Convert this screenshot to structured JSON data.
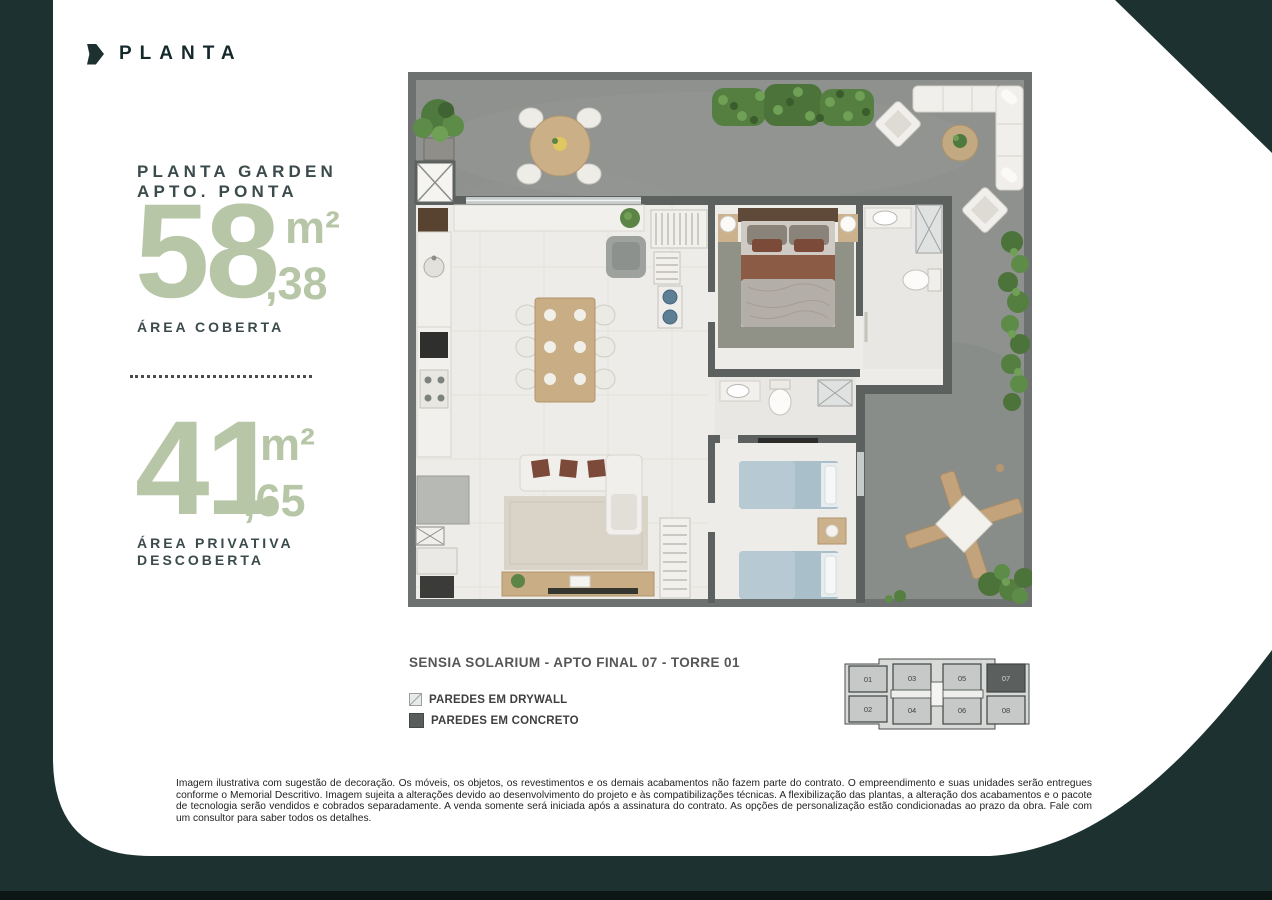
{
  "header": {
    "title": "PLANTA"
  },
  "colors": {
    "dark_green": "#1d3230",
    "sage": "#b8c6a8",
    "heading": "#3b4a4b"
  },
  "info": {
    "heading_line1": "PLANTA GARDEN",
    "heading_line2": "APTO. PONTA",
    "area_coberta": {
      "value": "58",
      "unit": "m²",
      "decimal": ",38",
      "label": "ÁREA COBERTA"
    },
    "area_descoberta": {
      "value": "41",
      "unit": "m²",
      "decimal": ",65",
      "label_line1": "ÁREA PRIVATIVA",
      "label_line2": "DESCOBERTA"
    }
  },
  "plan": {
    "caption": "SENSIA SOLARIUM - APTO FINAL 07 - TORRE 01",
    "legend": [
      {
        "type": "drywall",
        "label": "PAREDES EM DRYWALL"
      },
      {
        "type": "concrete",
        "label": "PAREDES EM CONCRETO"
      }
    ]
  },
  "keyplan": {
    "units_top": [
      "01",
      "03",
      "05",
      "07"
    ],
    "units_bottom": [
      "02",
      "04",
      "06",
      "08"
    ],
    "highlighted_unit": "07"
  },
  "disclaimer": "Imagem ilustrativa com sugestão de decoração. Os móveis, os objetos, os revestimentos e os demais acabamentos não fazem parte do contrato. O empreendimento e suas unidades serão entregues conforme o Memorial Descritivo. Imagem sujeita a alterações devido ao desenvolvimento do projeto e às compatibilizações técnicas. A flexibilização das plantas, a alteração dos acabamentos e o pacote de tecnologia serão vendidos e cobrados separadamente. A venda somente será iniciada após a assinatura do contrato. As opções de personalização estão condicionadas ao prazo da obra. Fale com um consultor para saber todos os detalhes."
}
